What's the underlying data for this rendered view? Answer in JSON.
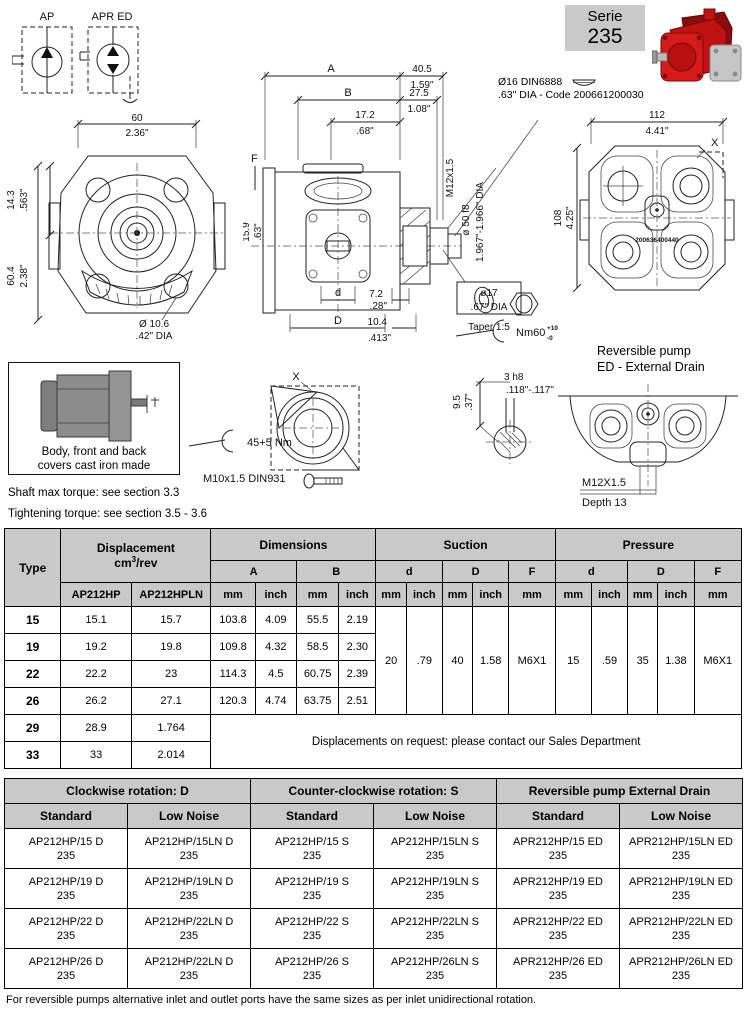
{
  "symbols": {
    "ap": "AP",
    "apr": "APR ED"
  },
  "serie": {
    "label": "Serie",
    "number": "235"
  },
  "front_view": {
    "w_mm": "60",
    "w_in": "2.36\"",
    "off_mm": "14.3",
    "off_in": ".563\"",
    "h_mm": "60.4",
    "h_in": "2.38\"",
    "hole": "Ø 10.6",
    "hole_in": ".42\" DIA"
  },
  "side_view": {
    "a": "A",
    "b": "B",
    "f": "F",
    "d_small": "d",
    "d_big": "D",
    "len1_mm": "40.5",
    "len1_in": "1.59\"",
    "len2_mm": "27.5",
    "len2_in": "1.08\"",
    "len3_mm": "17.2",
    "len3_in": ".68\"",
    "h_mm": "15.9",
    "h_in": ".63\"",
    "thread": "M12x1.5",
    "pilot": "ø 50 f8",
    "pilot_in": "1.967\"-1.966\" DIA",
    "shaft_d": "ø17",
    "shaft_d_in": ".67\" DIA",
    "taper": "Taper 1:5",
    "len4_mm": "7.2",
    "len4_in": ".28\"",
    "len5_mm": "10.4",
    "len5_in": ".413\"",
    "torque": "Nm60",
    "torque_plus": "+10",
    "torque_minus": "-0"
  },
  "key_callout": {
    "line1": "Ø16 DIN6888",
    "line2": ".63\" DIA - Code 200661200030"
  },
  "rear_view": {
    "w_mm": "112",
    "w_in": "4.41\"",
    "h_mm": "108",
    "h_in": "4.25\"",
    "x": "X",
    "part_no": "200636400440"
  },
  "material_box": {
    "line1": "Body, front and back",
    "line2": "covers cast iron made"
  },
  "notes": {
    "shaft": "Shaft max torque: see section 3.3",
    "tightening": "Tightening torque: see section 3.5 - 3.6"
  },
  "x_detail": {
    "x": "X",
    "torque": "45+5 Nm",
    "bolt": "M10x1.5 DIN931"
  },
  "key_detail": {
    "h_mm": "9.5",
    "h_in": ".37\"",
    "w": "3 h8",
    "w_in": ".118\"-.117\""
  },
  "reversible": {
    "title1": "Reversible pump",
    "title2": "ED - External Drain",
    "thread": "M12X1.5",
    "depth": "Depth 13"
  },
  "main_table": {
    "headers": {
      "type": "Type",
      "displacement": "Displacement",
      "unit_a": "cm",
      "unit_sup": "3",
      "unit_b": "/rev",
      "dimensions": "Dimensions",
      "suction": "Suction",
      "pressure": "Pressure",
      "hp": "AP212HP",
      "hpln": "AP212HPLN",
      "a": "A",
      "b": "B",
      "d": "d",
      "dd": "D",
      "f": "F",
      "mm": "mm",
      "inch": "inch"
    },
    "rows": [
      {
        "type": "15",
        "hp": "15.1",
        "hpln": "15.7",
        "a_mm": "103.8",
        "a_in": "4.09",
        "b_mm": "55.5",
        "b_in": "2.19"
      },
      {
        "type": "19",
        "hp": "19.2",
        "hpln": "19.8",
        "a_mm": "109.8",
        "a_in": "4.32",
        "b_mm": "58.5",
        "b_in": "2.30"
      },
      {
        "type": "22",
        "hp": "22.2",
        "hpln": "23",
        "a_mm": "114.3",
        "a_in": "4.5",
        "b_mm": "60.75",
        "b_in": "2.39"
      },
      {
        "type": "26",
        "hp": "26.2",
        "hpln": "27.1",
        "a_mm": "120.3",
        "a_in": "4.74",
        "b_mm": "63.75",
        "b_in": "2.51"
      },
      {
        "type": "29",
        "hp": "28.9",
        "hpln": "1.764"
      },
      {
        "type": "33",
        "hp": "33",
        "hpln": "2.014"
      }
    ],
    "suction": {
      "d_mm": "20",
      "d_in": ".79",
      "D_mm": "40",
      "D_in": "1.58",
      "f": "M6X1"
    },
    "pressure": {
      "d_mm": "15",
      "d_in": ".59",
      "D_mm": "35",
      "D_in": "1.38",
      "f": "M6X1"
    },
    "note": "Displacements on request: please contact our Sales Department"
  },
  "ordering": {
    "groups": [
      "Clockwise rotation: D",
      "Counter-clockwise rotation: S",
      "Reversible pump External Drain"
    ],
    "sub": {
      "standard": "Standard",
      "low_noise": "Low Noise"
    },
    "serie": "235",
    "rows": [
      [
        "AP212HP/15 D",
        "AP212HP/15LN D",
        "AP212HP/15 S",
        "AP212HP/15LN S",
        "APR212HP/15 ED",
        "APR212HP/15LN ED"
      ],
      [
        "AP212HP/19 D",
        "AP212HP/19LN D",
        "AP212HP/19 S",
        "AP212HP/19LN S",
        "APR212HP/19 ED",
        "APR212HP/19LN ED"
      ],
      [
        "AP212HP/22 D",
        "AP212HP/22LN D",
        "AP212HP/22 S",
        "AP212HP/22LN S",
        "APR212HP/22 ED",
        "APR212HP/22LN ED"
      ],
      [
        "AP212HP/26 D",
        "AP212HP/22LN D",
        "AP212HP/26 S",
        "AP212HP/26LN S",
        "APR212HP/26 ED",
        "APR212HP/26LN ED"
      ]
    ]
  },
  "footer": "For reversible pumps alternative inlet and outlet ports have the same sizes as per inlet unidirectional rotation."
}
